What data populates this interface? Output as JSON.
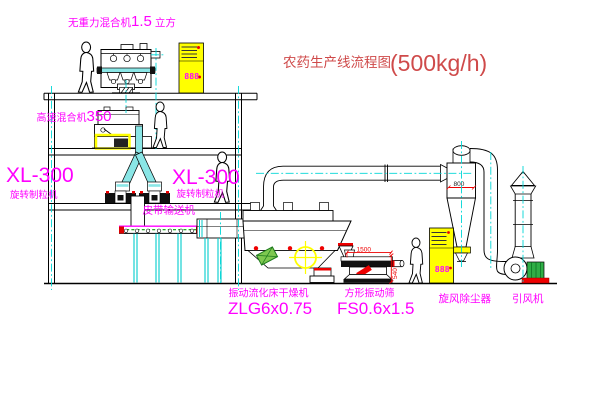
{
  "title": {
    "text": "农药生产线流程图",
    "capacity": "(500kg/h)"
  },
  "equipment": {
    "mixer1": {
      "name": "无重力混合机",
      "size": "1.5",
      "unit": "立方"
    },
    "mixer2": {
      "name": "高速混合机",
      "size": "350"
    },
    "granulator_left": {
      "model": "XL-300",
      "name": "旋转制粒机"
    },
    "granulator_center": {
      "model": "XL-300",
      "name": "旋转制粒机"
    },
    "conveyor": {
      "name": "皮带输送机"
    },
    "dryer": {
      "name": "振动流化床干燥机",
      "model": "ZLG6x0.75"
    },
    "sieve": {
      "name": "方形振动筛",
      "model": "FS0.6x1.5"
    },
    "cyclone": {
      "name": "旋风除尘器"
    },
    "fan": {
      "name": "引风机"
    }
  },
  "dimensions": {
    "cyclone_width": "800",
    "sieve_length": "1500",
    "sieve_height": "540"
  },
  "displays": {
    "cabinet1": "888",
    "cabinet2": "888"
  },
  "colors": {
    "label": "#ff00ff",
    "title": "#cf4a4a",
    "dimension": "#ee0000",
    "centerline": "#00d6d6",
    "highlight": "#ffff00",
    "pipe_fill": "#8ae6e6",
    "line": "#000000",
    "background": "#ffffff"
  }
}
